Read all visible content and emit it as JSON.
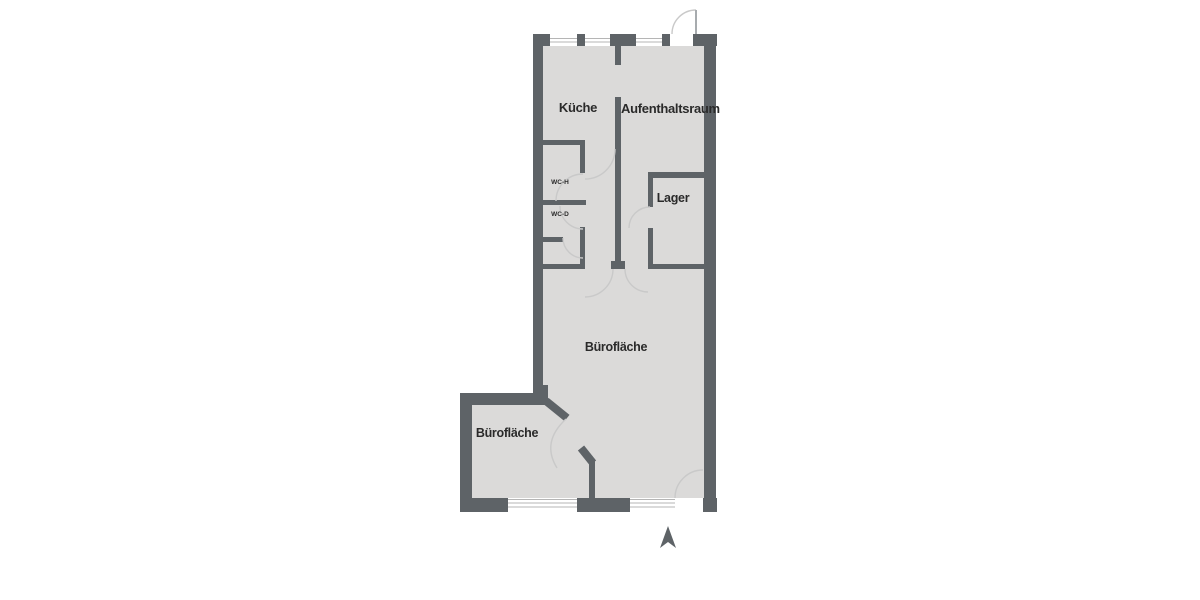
{
  "plan": {
    "type": "floor-plan",
    "language": "de",
    "colors": {
      "wall": "#5e6367",
      "floor": "#dbdad9",
      "label_text": "#2a2a2a",
      "door_arc": "#c9c9c9",
      "window_line": "#b5b5b5",
      "background": "#ffffff"
    },
    "rooms": [
      {
        "id": "kueche",
        "label": "Küche"
      },
      {
        "id": "aufenthaltsraum",
        "label": "Aufenthaltsraum"
      },
      {
        "id": "wc_h",
        "label": "WC-H"
      },
      {
        "id": "wc_d",
        "label": "WC-D"
      },
      {
        "id": "lager",
        "label": "Lager"
      },
      {
        "id": "buero_main",
        "label": "Bürofläche"
      },
      {
        "id": "buero_small",
        "label": "Bürofläche"
      }
    ],
    "icons": [
      {
        "name": "north-arrow-icon",
        "meaning": "north direction indicator"
      }
    ]
  }
}
